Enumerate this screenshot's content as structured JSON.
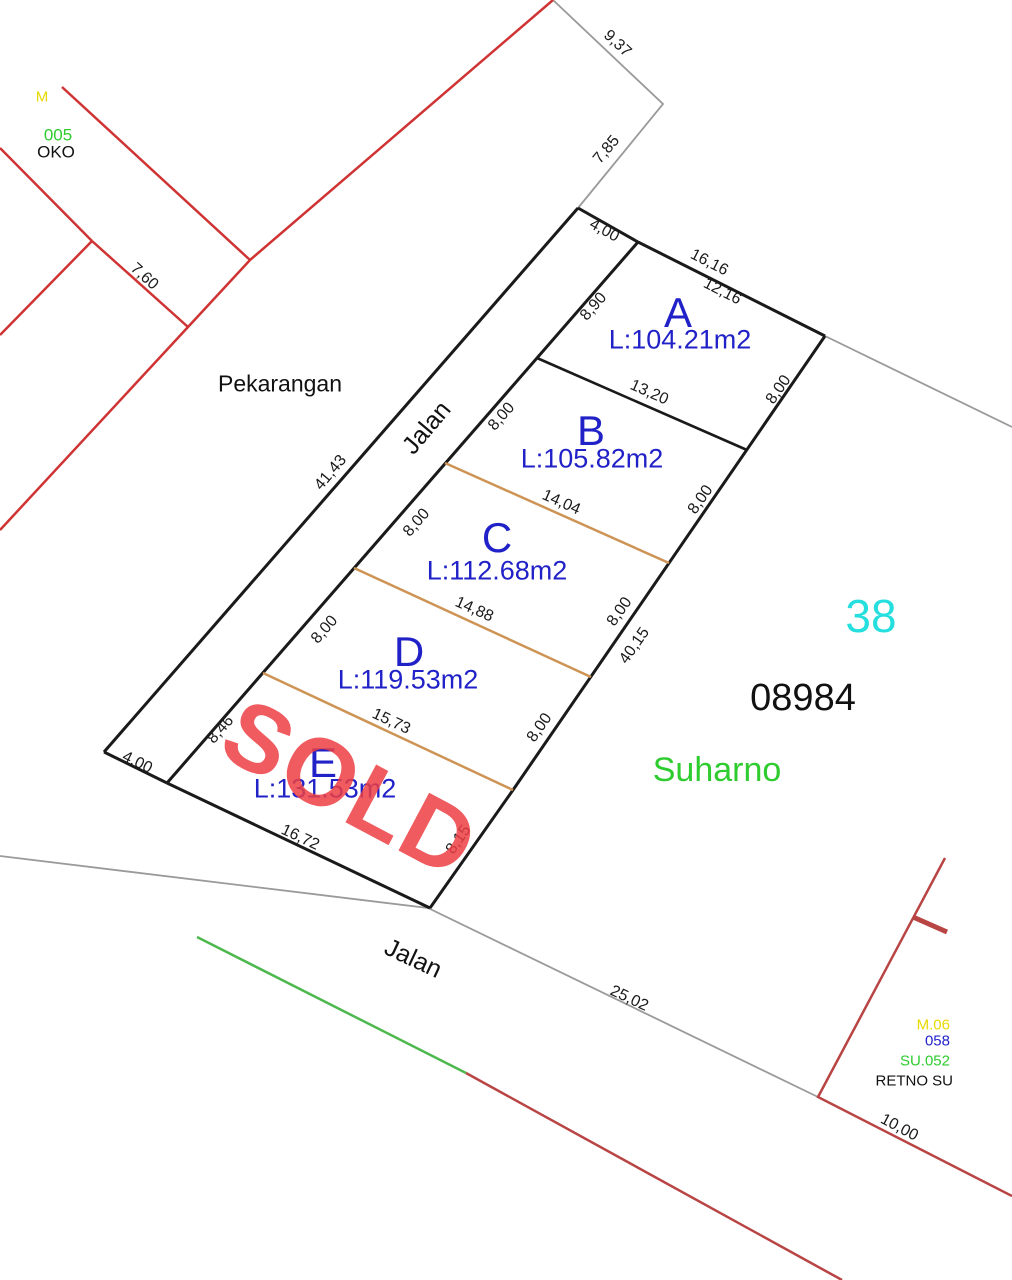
{
  "title": "Kavling site plan",
  "colors": {
    "lot_text": "#2121c8",
    "boundary_black": "#1a1a1a",
    "boundary_gray": "#9a9a9a",
    "divider_orange": "#cd9455",
    "boundary_red_nw": "#cf3333",
    "boundary_red_se": "#b94444",
    "boundary_green": "#4db84d",
    "sold_red": "#ec3e42",
    "block_cyan": "#25dede",
    "owner_green": "#2ecc2e",
    "code_yellow": "#e8d900",
    "code_blue": "#2222cc"
  },
  "labels": {
    "pekarangan": "Pekarangan",
    "road_top": "Jalan",
    "road_bottom": "Jalan",
    "block_no": "38",
    "sheet_no": "08984",
    "owner": "Suharno",
    "sold": "SOLD"
  },
  "lots": {
    "a": {
      "id": "A",
      "area": "L:104.21m2"
    },
    "b": {
      "id": "B",
      "area": "L:105.82m2"
    },
    "c": {
      "id": "C",
      "area": "L:112.68m2"
    },
    "d": {
      "id": "D",
      "area": "L:119.53m2"
    },
    "e": {
      "id": "E",
      "area": "L:131.53m2"
    }
  },
  "dims": {
    "bd_9_37": "9,37",
    "bd_7_85": "7,85",
    "bd_7_60": "7,60",
    "cap_top_4_00": "4,00",
    "a_top_outer_16_16": "16,16",
    "a_top_12_16": "12,16",
    "a_left_8_90": "8,90",
    "a_right_8_00": "8,00",
    "ab_13_20": "13,20",
    "b_left_8_00": "8,00",
    "b_right_8_00": "8,00",
    "bc_14_04": "14,04",
    "c_left_8_00": "8,00",
    "c_right_8_00": "8,00",
    "cd_14_88": "14,88",
    "d_left_8_00": "8,00",
    "d_right_8_00": "8,00",
    "de_15_73": "15,73",
    "e_left_8_46": "8,46",
    "e_right_8_15": "8,15",
    "e_bottom_16_72": "16,72",
    "east_total_40_15": "40,15",
    "road_top_41_43": "41,43",
    "cap_bottom_4_00": "4,00",
    "road_bottom_25_02": "25,02",
    "se_parcel_10_00": "10,00"
  },
  "neighbor_nw": {
    "yellow_fragment": "M",
    "green_code": "005",
    "name": "OKO"
  },
  "neighbor_se": {
    "yellow_code": "M.06",
    "blue_code": "058",
    "green_code": "SU.052",
    "name": "RETNO SU"
  }
}
